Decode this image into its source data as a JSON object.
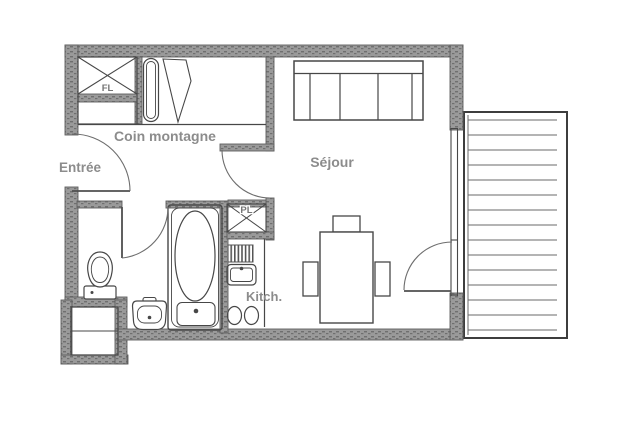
{
  "floor_plan": {
    "rooms": {
      "entree": "Entrée",
      "coin_montagne": "Coin montagne",
      "sejour": "Séjour",
      "kitchen": "Kitch."
    },
    "closets": {
      "fl": "FL",
      "pl": "PL"
    },
    "colors": {
      "background": "#ffffff",
      "wall_fill": "#9a9a9a",
      "wall_speckle": "#6f6f6f",
      "line": "#474747",
      "label": "#8c8c8c"
    }
  }
}
